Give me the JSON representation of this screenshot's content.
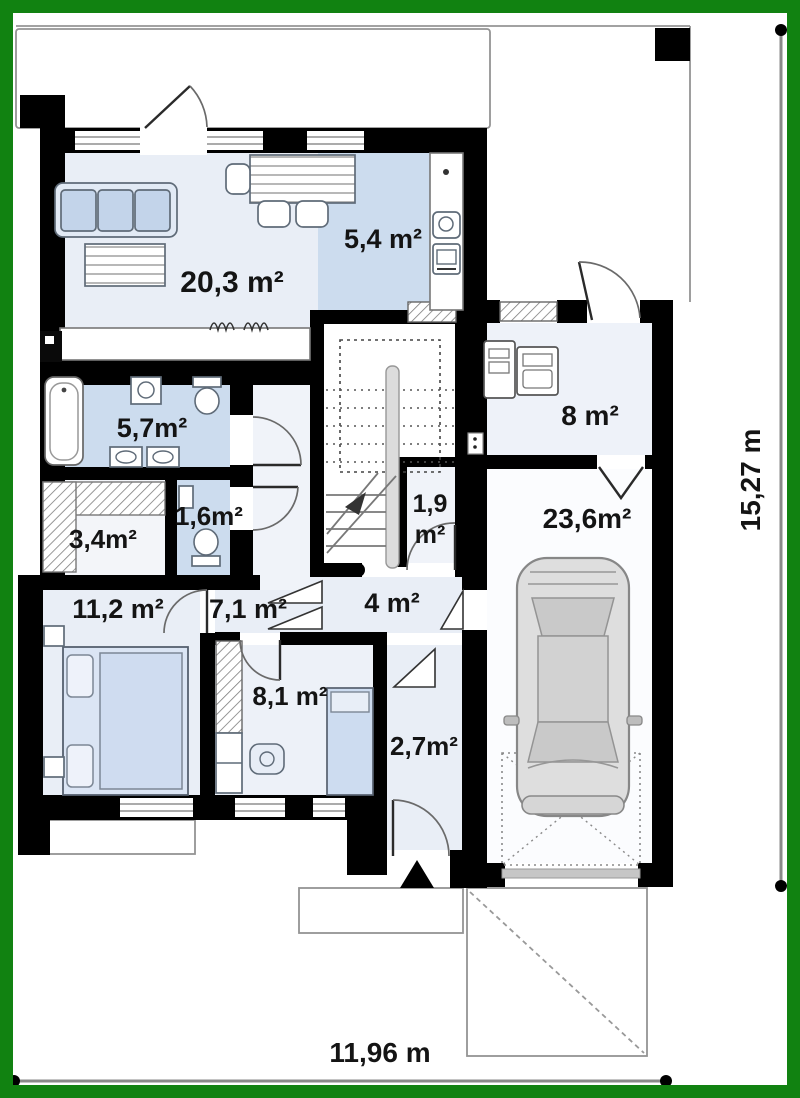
{
  "plan": {
    "type": "house-floor-plan",
    "floor": "ground-floor"
  },
  "rooms": {
    "living": {
      "label": "20,3 m²",
      "area_m2": 20.3,
      "floor": "light-blue"
    },
    "kitchen": {
      "label": "5,4 m²",
      "area_m2": 5.4,
      "floor": "blue"
    },
    "bathroom": {
      "label": "5,7m²",
      "area_m2": 5.7,
      "floor": "blue"
    },
    "wardrobe": {
      "label": "3,4m²",
      "area_m2": 3.4,
      "floor": "white"
    },
    "wc": {
      "label": "1,6m²",
      "area_m2": 1.6,
      "floor": "blue"
    },
    "bedroom": {
      "label": "11,2 m²",
      "area_m2": 11.2,
      "floor": "light-blue"
    },
    "hall": {
      "label": "7,1 m²",
      "area_m2": 7.1,
      "floor": "light-blue"
    },
    "room81": {
      "label": "8,1 m²",
      "area_m2": 8.1,
      "floor": "light-blue"
    },
    "vestibule": {
      "label": "2,7m²",
      "area_m2": 2.7,
      "floor": "light-blue"
    },
    "hall4": {
      "label": "4 m²",
      "area_m2": 4.0,
      "floor": "light-blue"
    },
    "closet": {
      "label_line1": "1,9",
      "label_line2": "m²",
      "area_m2": 1.9,
      "floor": "white"
    },
    "utility": {
      "label": "8 m²",
      "area_m2": 8.0,
      "floor": "white"
    },
    "garage": {
      "label": "23,6m²",
      "area_m2": 23.6,
      "floor": "white"
    }
  },
  "dimensions": {
    "overall_width": "11,96 m",
    "overall_height": "15,27 m"
  },
  "markers": {
    "entrance": "entrance-triangle-marker",
    "stairs": "staircase-up",
    "car": "car-top-view"
  },
  "colors": {
    "frame_green": "#118211",
    "wall_black": "#000000",
    "floor_light": "#e9eef6",
    "floor_blue": "#ccdcee",
    "furniture_blue": "#c3d4ea",
    "outline_gray": "#949494",
    "car_gray": "#d9d9d9"
  }
}
